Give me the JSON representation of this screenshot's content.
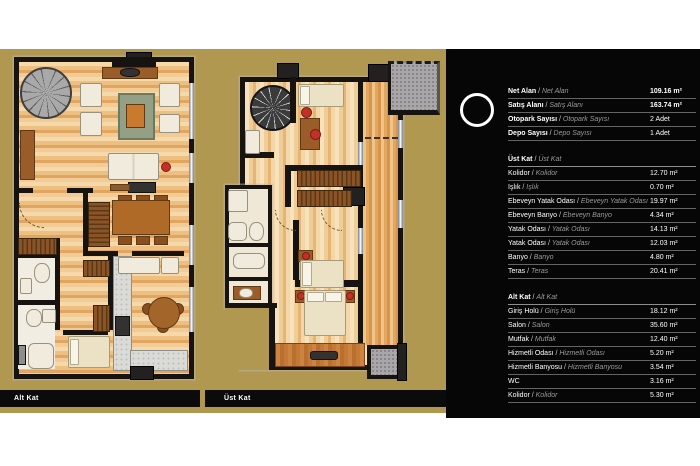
{
  "plans": {
    "alt_kat_label": "Alt Kat",
    "ust_kat_label": "Üst Kat"
  },
  "panel": {
    "summary_rows": [
      {
        "label": "Net Alan",
        "label_alt": "Net Alan",
        "value": "109.16 m²"
      },
      {
        "label": "Satış Alanı",
        "label_alt": "Satış Alanı",
        "value": "163.74 m²"
      },
      {
        "label": "Otopark Sayısı",
        "label_alt": "Otopark Sayısı",
        "value": "2 Adet"
      },
      {
        "label": "Depo Sayısı",
        "label_alt": "Depo Sayısı",
        "value": "1 Adet"
      }
    ],
    "sections": [
      {
        "title": "Üst Kat",
        "title_alt": "Üst Kat",
        "rows": [
          {
            "label": "Kolidor",
            "label_alt": "Kolidor",
            "value": "12.70 m²"
          },
          {
            "label": "Işlık",
            "label_alt": "Işlık",
            "value": "0.70 m²"
          },
          {
            "label": "Ebeveyn Yatak Odası",
            "label_alt": "Ebeveyn Yatak Odası",
            "value": "19.97 m²"
          },
          {
            "label": "Ebeveyn Banyo",
            "label_alt": "Ebeveyn Banyo",
            "value": "4.34 m²"
          },
          {
            "label": "Yatak Odası",
            "label_alt": "Yatak Odası",
            "value": "14.13 m²"
          },
          {
            "label": "Yatak Odası",
            "label_alt": "Yatak Odası",
            "value": "12.03 m²"
          },
          {
            "label": "Banyo",
            "label_alt": "Banyo",
            "value": "4.80 m²"
          },
          {
            "label": "Teras",
            "label_alt": "Teras",
            "value": "20.41 m²"
          }
        ]
      },
      {
        "title": "Alt Kat",
        "title_alt": "Alt Kat",
        "rows": [
          {
            "label": "Giriş Holü",
            "label_alt": "Giriş Holü",
            "value": "18.12 m²"
          },
          {
            "label": "Salon",
            "label_alt": "Salon",
            "value": "35.60 m²"
          },
          {
            "label": "Mutfak",
            "label_alt": "Mutfak",
            "value": "12.40 m²"
          },
          {
            "label": "Hizmetli Odası",
            "label_alt": "Hizmetli Odası",
            "value": "5.20 m²"
          },
          {
            "label": "Hizmetli Banyosu",
            "label_alt": "Hizmetli Banyosu",
            "value": "3.54 m²"
          },
          {
            "label": "WC",
            "label_alt": "",
            "value": "3.16 m²"
          },
          {
            "label": "Kolidor",
            "label_alt": "Kolidor",
            "value": "5.30 m²"
          }
        ]
      }
    ]
  },
  "colors": {
    "background_gold": "#b19851",
    "panel_black": "#060606",
    "wall_black": "#171310",
    "wood_light": "#f3d7a9",
    "accent_red": "#c23127",
    "text_white": "#ffffff",
    "text_italic_gray": "#9a9a9a"
  }
}
